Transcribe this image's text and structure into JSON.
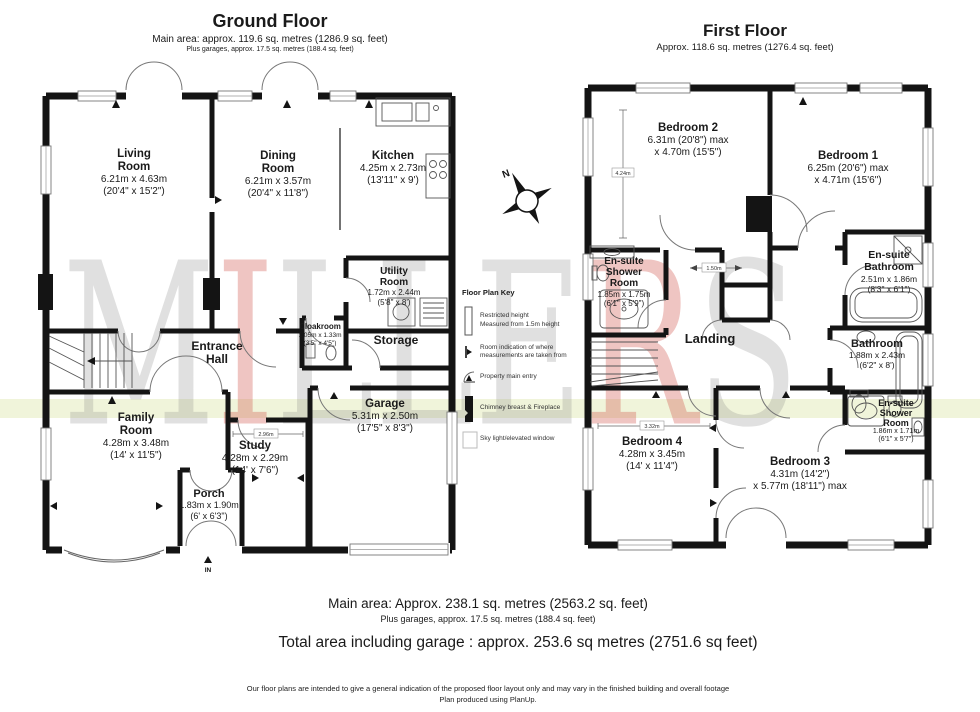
{
  "ground_floor": {
    "title": "Ground Floor",
    "area_line": "Main area: approx. 119.6 sq. metres (1286.9 sq. feet)",
    "garage_line": "Plus garages, approx. 17.5 sq. metres (188.4 sq. feet)",
    "entry_label": "IN",
    "rooms": {
      "living_room": {
        "name": "Living Room",
        "dim_metric": "6.21m x 4.63m",
        "dim_imperial": "(20'4\" x 15'2\")"
      },
      "dining_room": {
        "name": "Dining Room",
        "dim_metric": "6.21m x 3.57m",
        "dim_imperial": "(20'4\" x 11'8\")"
      },
      "kitchen": {
        "name": "Kitchen",
        "dim_metric": "4.25m x 2.73m",
        "dim_imperial": "(13'11\" x 9')"
      },
      "utility_room": {
        "name": "Utility Room",
        "dim_metric": "1.72m x 2.44m",
        "dim_imperial": "(5'8\" x 8')"
      },
      "storage": {
        "name": "Storage"
      },
      "cloakroom": {
        "name": "Cloakroom",
        "dim_metric": "1.05m x 1.33m",
        "dim_imperial": "(3'5\" x 4'5\")"
      },
      "entrance_hall": {
        "name": "Entrance Hall"
      },
      "family_room": {
        "name": "Family Room",
        "dim_metric": "4.28m x 3.48m",
        "dim_imperial": "(14' x 11'5\")"
      },
      "study": {
        "name": "Study",
        "dim_metric": "4.28m x 2.29m",
        "dim_imperial": "(14' x 7'6\")"
      },
      "porch": {
        "name": "Porch",
        "dim_metric": "1.83m x 1.90m",
        "dim_imperial": "(6' x 6'3\")"
      },
      "garage": {
        "name": "Garage",
        "dim_metric": "5.31m x 2.50m",
        "dim_imperial": "(17'5\" x 8'3\")"
      }
    }
  },
  "first_floor": {
    "title": "First Floor",
    "area_line": "Approx. 118.6 sq. metres (1276.4 sq. feet)",
    "rooms": {
      "bedroom_2": {
        "name": "Bedroom 2",
        "dim_metric": "6.31m (20'8\") max",
        "dim_imperial": "x 4.70m (15'5\")"
      },
      "bedroom_1": {
        "name": "Bedroom 1",
        "dim_metric": "6.25m (20'6\") max",
        "dim_imperial": "x 4.71m (15'6\")"
      },
      "ensuite_shower_1": {
        "name": "En-suite Shower Room",
        "dim_metric": "1.85m x 1.75m",
        "dim_imperial": "(6'1\" x 5'9\")"
      },
      "ensuite_bathroom": {
        "name": "En-suite Bathroom",
        "dim_metric": "2.51m x 1.86m",
        "dim_imperial": "(8'3\" x 6'1\")"
      },
      "landing": {
        "name": "Landing"
      },
      "bathroom": {
        "name": "Bathroom",
        "dim_metric": "1.88m x 2.43m",
        "dim_imperial": "(6'2\" x 8')"
      },
      "ensuite_shower_2": {
        "name": "En-suite Shower Room",
        "dim_metric": "1.86m x 1.71m",
        "dim_imperial": "(6'1\" x 5'7\")"
      },
      "bedroom_4": {
        "name": "Bedroom 4",
        "dim_metric": "4.28m x 3.45m",
        "dim_imperial": "(14' x 11'4\")"
      },
      "bedroom_3": {
        "name": "Bedroom 3",
        "dim_metric": "4.31m (14'2\")",
        "dim_imperial": "x 5.77m (18'11\") max"
      }
    }
  },
  "key": {
    "title": "Floor Plan Key",
    "items": [
      {
        "line1": "Restricted height",
        "line2": "Measured from 1.5m height"
      },
      {
        "line1": "Room indication of where",
        "line2": "measurements are taken from"
      },
      {
        "line1": "Property main entry",
        "line2": ""
      },
      {
        "line1": "Chimney breast & Fireplace",
        "line2": ""
      },
      {
        "line1": "Sky light/elevated window",
        "line2": ""
      }
    ]
  },
  "annotations": {
    "compass": "N",
    "dim_bedroom2": "4.24m",
    "dim_landing": "1.50m",
    "dim_bedroom4": "3.32m",
    "dim_study": "2.96m"
  },
  "watermark": {
    "letters": [
      {
        "char": "M"
      },
      {
        "char": "I"
      },
      {
        "char": "L"
      },
      {
        "char": "L"
      },
      {
        "char": "E"
      },
      {
        "char": "R"
      },
      {
        "char": "S"
      }
    ]
  },
  "footer": {
    "main_area": "Main area: Approx. 238.1 sq. metres (2563.2 sq. feet)",
    "plus_garages": "Plus garages, approx. 17.5 sq. metres (188.4 sq. feet)",
    "total_area": "Total area including garage : approx. 253.6 sq metres (2751.6 sq feet)",
    "disclaimer1": "Our floor plans are intended to give a general indication of the proposed floor layout only and may vary  in the finished building and overall footage",
    "disclaimer2": "Plan produced using PlanUp."
  },
  "colors": {
    "wall": "#141414",
    "band": "#f0f4da",
    "watermark_gray": "#828282",
    "watermark_red": "#cd5046"
  }
}
